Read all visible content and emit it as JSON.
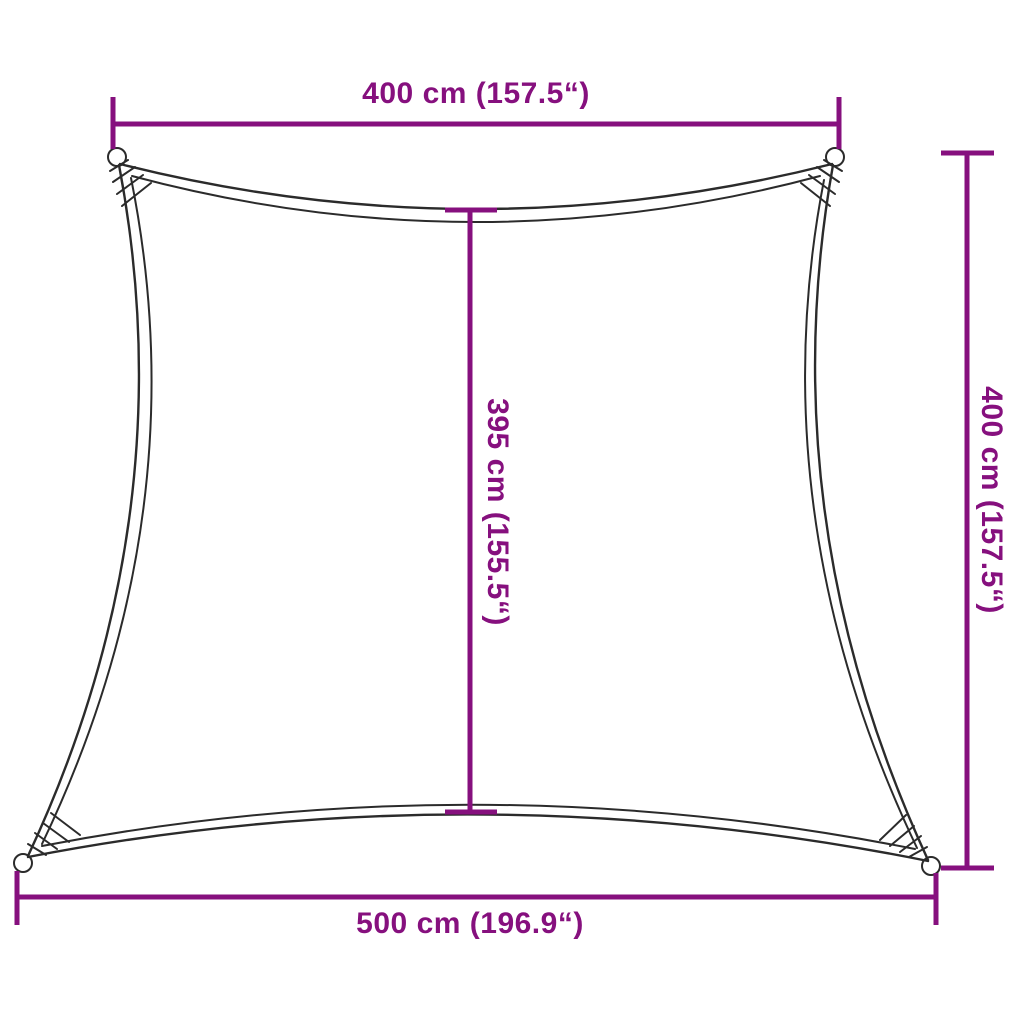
{
  "diagram": {
    "type": "product-dimension-diagram",
    "subject": "shade-sail-trapezoid",
    "accent_color": "#86107E",
    "outline_color": "#2b2b2b",
    "background_color": "#ffffff",
    "labels": {
      "top": "400 cm (157.5“)",
      "middle": "395 cm (155.5“)",
      "right": "400 cm (157.5“)",
      "bottom": "500 cm (196.9“)"
    }
  }
}
